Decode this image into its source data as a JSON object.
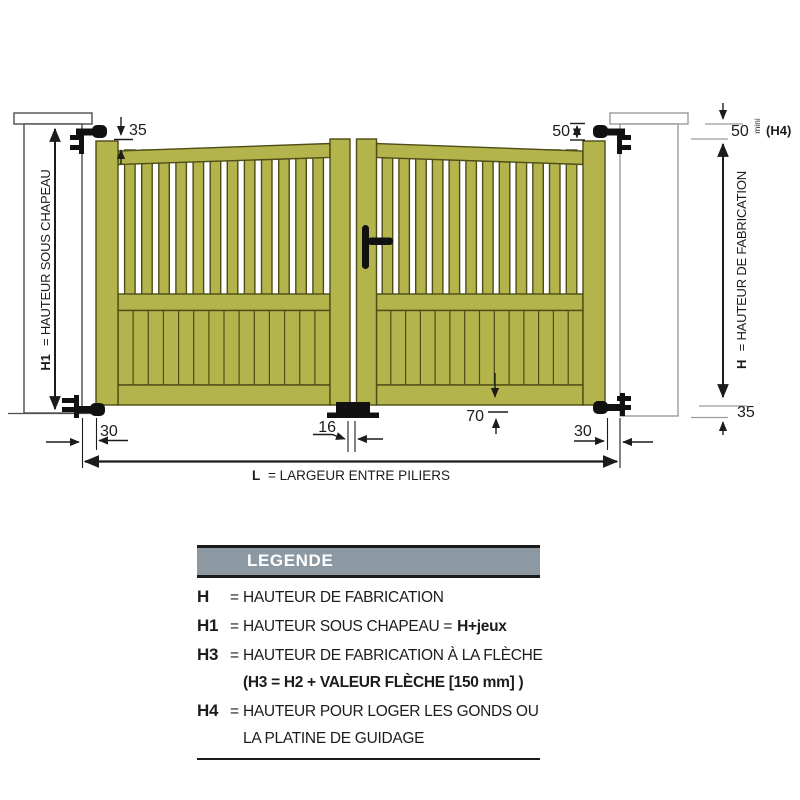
{
  "diagram": {
    "dims": {
      "top_offset": "35",
      "top_clearance": "50",
      "h4_value": "50",
      "h4_unit": "mini",
      "h4_name": "(H4)",
      "h1_term": "H1",
      "h1_label": "= HAUTEUR SOUS CHAPEAU",
      "h_term": "H",
      "h_label": "= HAUTEUR DE FABRICATION",
      "ground_clearance": "35",
      "bottom_rail": "70",
      "left_gap": "30",
      "center_gap": "16",
      "right_gap": "30",
      "l_term": "L",
      "l_label": "= LARGEUR ENTRE PILIERS"
    },
    "colors": {
      "gate_fill": "#b3b44b",
      "gate_outline": "#4e4c17",
      "pillar_outline": "#4d4d4d",
      "reference_line": "#9b9b9b",
      "dimension_line": "#1c1c1c",
      "hardware": "#111111",
      "legend_header_bg": "#8c98a2"
    }
  },
  "legend": {
    "title": "LEGENDE",
    "rows": [
      {
        "term": "H",
        "eq": "=",
        "text": "HAUTEUR DE FABRICATION"
      },
      {
        "term": "H1",
        "eq": "=",
        "text": "HAUTEUR SOUS CHAPEAU =",
        "bold": "H+jeux"
      },
      {
        "term": "H3",
        "eq": "=",
        "text": "HAUTEUR DE FABRICATION À LA FLÈCHE"
      },
      {
        "cont_bold": "(H3 = H2 + VALEUR FLÈCHE [150 mm] )"
      },
      {
        "term": "H4",
        "eq": "=",
        "text": "HAUTEUR POUR LOGER LES GONDS OU"
      },
      {
        "cont": "LA PLATINE DE GUIDAGE"
      }
    ]
  }
}
